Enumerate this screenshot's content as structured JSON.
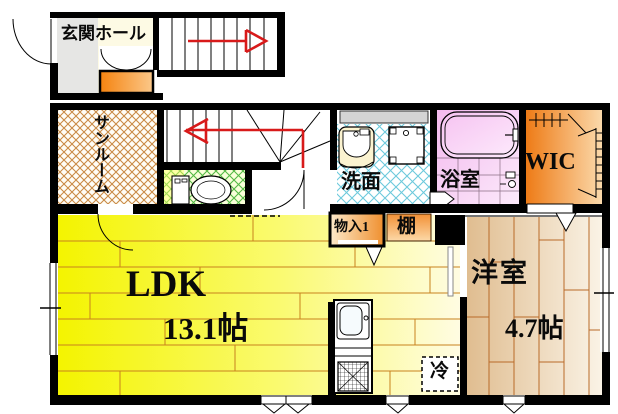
{
  "plan": {
    "type": "apartment-floor-plan",
    "rooms": {
      "entrance_hall": {
        "label": "玄関ホール"
      },
      "sunroom": {
        "label": "サンルーム"
      },
      "washroom": {
        "label": "洗面"
      },
      "bathroom": {
        "label": "浴室"
      },
      "wic": {
        "label": "WIC"
      },
      "storage1": {
        "label": "物入1"
      },
      "shelf": {
        "label": "棚"
      },
      "ldk": {
        "label": "LDK",
        "size": "13.1帖"
      },
      "western_room": {
        "label": "洋室",
        "size": "4.7帖"
      },
      "refrigerator": {
        "label": "冷"
      }
    },
    "colors": {
      "wall": "#000000",
      "stair_arrow": "#d81a1a",
      "ldk_floor_left": "#f4f400",
      "ldk_floor_right": "#fffce2",
      "plank_line": "#c8821e",
      "western_floor_left": "#e0bd90",
      "western_floor_right": "#faf3e6",
      "sunroom_hatch": "#c98a45",
      "toilet_hatch": "#54b944",
      "washroom_hatch": "#6cc9dc",
      "bathroom_pink": "#f3b9ee",
      "wic_orange": "#ee7b16",
      "shoebox_orange": "#f5830f"
    }
  }
}
